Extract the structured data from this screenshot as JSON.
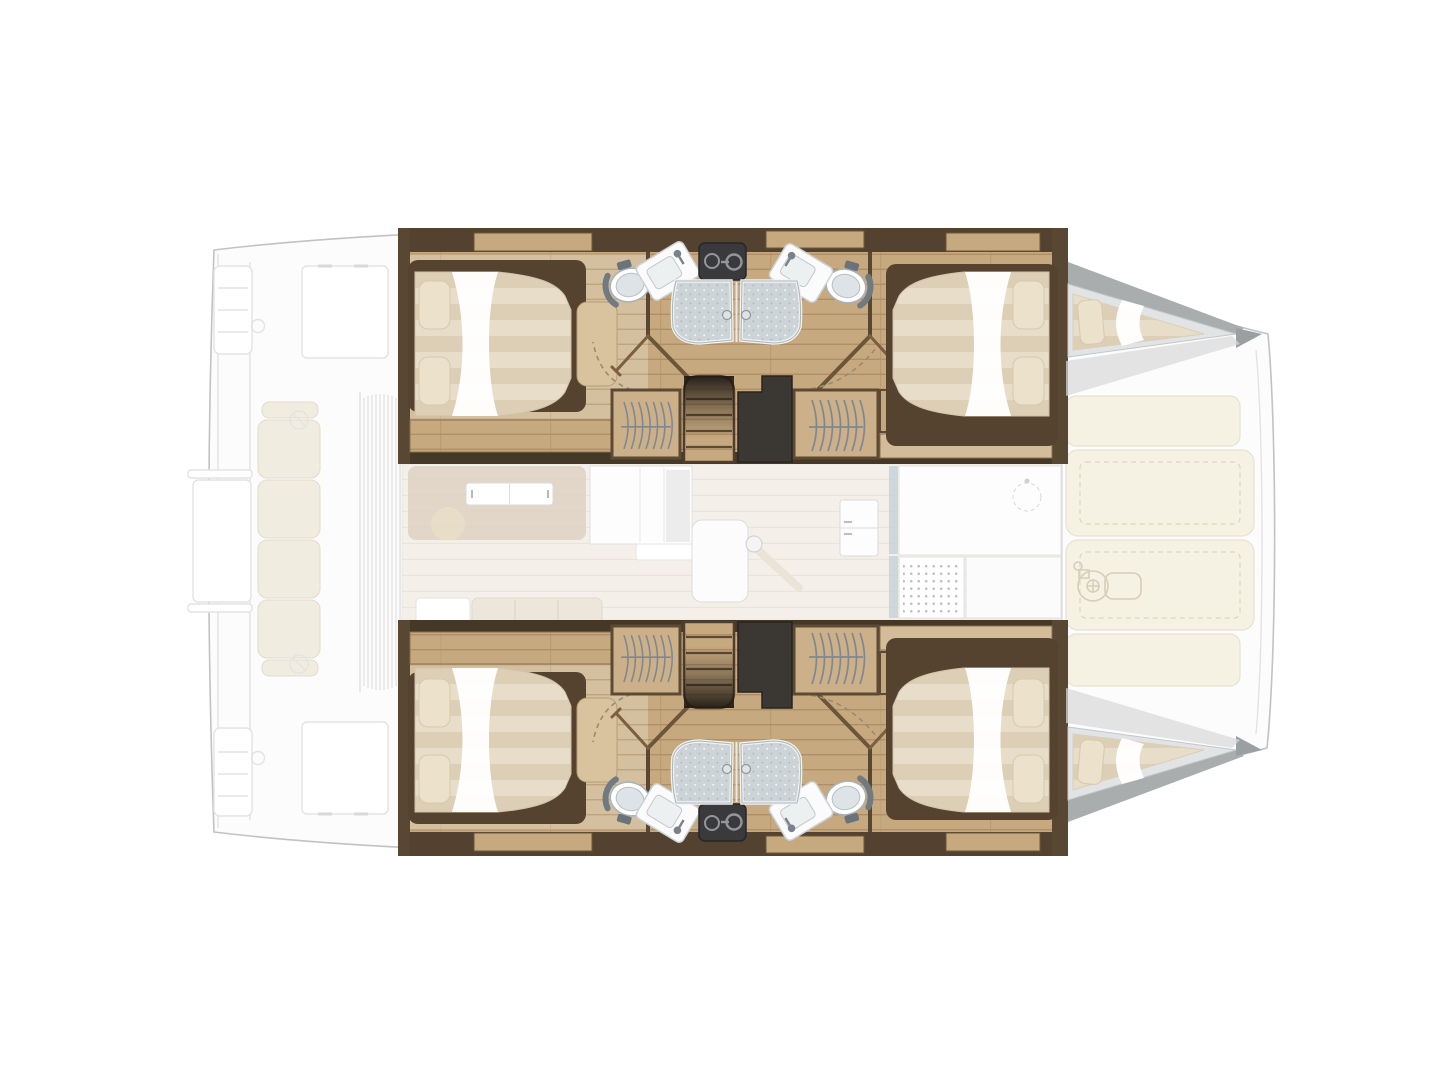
{
  "figure": {
    "type": "catamaran-deck-plan",
    "view": "top-down",
    "orientation": "bow-right",
    "double_cabins": 4,
    "bathrooms": 4,
    "shower_stalls": 4,
    "forepeak_berths": 2,
    "sunpads": 4,
    "rendering": "accommodation decks solid, exterior decks ghosted"
  },
  "areas": [
    {
      "id": "aft-cockpit",
      "style": "ghosted"
    },
    {
      "id": "salon-galley",
      "style": "ghosted"
    },
    {
      "id": "port-hull",
      "style": "solid",
      "contains": [
        "aft-cabin",
        "two-bathrooms",
        "stairs",
        "wardrobes",
        "forward-cabin",
        "forepeak-berth"
      ]
    },
    {
      "id": "starboard-hull",
      "style": "solid",
      "contains": [
        "aft-cabin",
        "two-bathrooms",
        "stairs",
        "wardrobes",
        "forward-cabin",
        "forepeak-berth"
      ]
    },
    {
      "id": "foredeck-sunpads",
      "style": "ghosted"
    }
  ],
  "icons": [
    {
      "name": "hanging-clothes-icon",
      "shape": "wavy-curves-over-rod"
    },
    {
      "name": "door-swing-icon",
      "shape": "dashed-quarter-arc"
    },
    {
      "name": "windlass-icon",
      "shape": "outline-winch-with-motor"
    },
    {
      "name": "power-icon",
      "shape": "circle-with-bar"
    },
    {
      "name": "winch-icon",
      "shape": "circle-with-diagonal"
    }
  ],
  "palette": {
    "page-bg": "#ffffff",
    "hull-line": "#c2c2c2",
    "ghost-fill": "#fcfcfc",
    "ghost-line": "#e3e3e3",
    "ghost-furniture": "#f0ecdf",
    "wood-dark": "#53422f",
    "wood-dark2": "#463827",
    "wood-end": "#584733",
    "wood-mid": "#6b5639",
    "wood-trim": "#8a6f4e",
    "wood-floor": "#c6a97f",
    "wood-floor-line": "#b08f66",
    "wood-floor-light": "#d4bf9e",
    "wood-floor-light-line": "#bfa57d",
    "cabinet-tan": "#cbb089",
    "mattress-a": "#e8ddc8",
    "mattress-b": "#dccfb5",
    "pillow": "#ece1cb",
    "sheet": "#ffffff",
    "bed-frame": "#55432f",
    "fixture-white": "#fbfbfb",
    "toilet-seat": "#dde3e6",
    "toilet-arm": "#717a80",
    "shower-fill": "#ccd4d7",
    "shower-knob": "#dfe3e4",
    "utility-box": "#3a3a3c",
    "utility-glyph": "#93969a",
    "void-dark": "#3b3733",
    "stair-shadow": "#201a14",
    "door-leaf": "#7a5f40",
    "door-dash": "#9b8a70",
    "hanger-line": "#7f8890",
    "forepeak-wall": "#a9adae",
    "forepeak-floor": "#e2e3e4",
    "bow-tip": "#9aa0a2",
    "antislip": "#dadada",
    "sunpad": "#f5f1e3",
    "sunpad-line": "#ddd5bf",
    "accent-blue": "#c6d3db",
    "salon-floor": "#f4f0e9"
  }
}
